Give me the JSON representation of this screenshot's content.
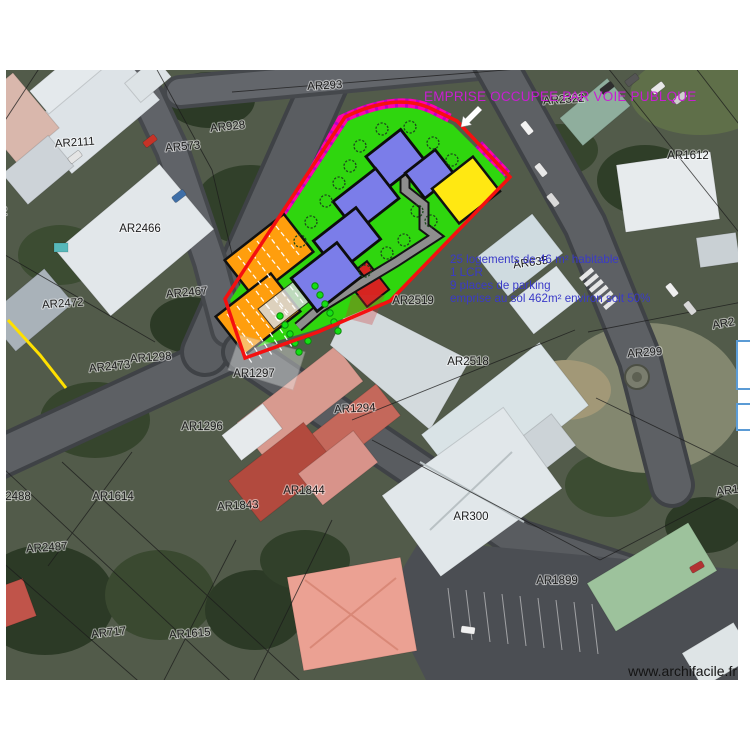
{
  "overlay": {
    "title": "EMPRISE OCCUPEE PAR VOIE PUBLQUE"
  },
  "annotations": {
    "line1": "25 logements de 46 m² habitable",
    "line2": "1 LCR",
    "line3": "9 places de parking",
    "line4": "emprise au sol 462m² environ soit 50%"
  },
  "watermark": "www.archifacile.fr",
  "parcels": [
    {
      "label": "AR293",
      "x": 325,
      "y": 89,
      "rot": -3
    },
    {
      "label": "AR2322",
      "x": 564,
      "y": 103,
      "rot": -4
    },
    {
      "label": "AR928",
      "x": 228,
      "y": 130,
      "rot": -6
    },
    {
      "label": "AR2111",
      "x": 75,
      "y": 146,
      "rot": -4
    },
    {
      "label": "AR573",
      "x": 183,
      "y": 150,
      "rot": -5
    },
    {
      "label": "AR1612",
      "x": 688,
      "y": 159,
      "rot": 0
    },
    {
      "label": "AR2466",
      "x": 140,
      "y": 232,
      "rot": 0
    },
    {
      "label": "AR2472",
      "x": 63,
      "y": 307,
      "rot": -4
    },
    {
      "label": "AR2467",
      "x": 187,
      "y": 296,
      "rot": -5
    },
    {
      "label": "AR635",
      "x": 531,
      "y": 266,
      "rot": -8
    },
    {
      "label": "AR2519",
      "x": 413,
      "y": 304,
      "rot": 0
    },
    {
      "label": "AR2473",
      "x": 110,
      "y": 370,
      "rot": -6
    },
    {
      "label": "AR1298",
      "x": 151,
      "y": 361,
      "rot": -4
    },
    {
      "label": "AR1297",
      "x": 254,
      "y": 377,
      "rot": 0
    },
    {
      "label": "AR2518",
      "x": 468,
      "y": 365,
      "rot": 0
    },
    {
      "label": "AR299",
      "x": 645,
      "y": 356,
      "rot": -4
    },
    {
      "label": "AR1294",
      "x": 355,
      "y": 412,
      "rot": -3
    },
    {
      "label": "AR1296",
      "x": 202,
      "y": 430,
      "rot": 0
    },
    {
      "label": "2488",
      "x": 18,
      "y": 500,
      "rot": 0
    },
    {
      "label": "AR1614",
      "x": 113,
      "y": 500,
      "rot": 0
    },
    {
      "label": "AR1844",
      "x": 304,
      "y": 494,
      "rot": 0
    },
    {
      "label": "AR1843",
      "x": 238,
      "y": 509,
      "rot": -3
    },
    {
      "label": "AR300",
      "x": 471,
      "y": 520,
      "rot": 0
    },
    {
      "label": "AR2487",
      "x": 47,
      "y": 551,
      "rot": -4
    },
    {
      "label": "AR1899",
      "x": 557,
      "y": 584,
      "rot": 0
    },
    {
      "label": "AR717",
      "x": 109,
      "y": 636,
      "rot": -6
    },
    {
      "label": "AR1615",
      "x": 190,
      "y": 637,
      "rot": -4
    },
    {
      "label": "AR2",
      "x": 724,
      "y": 327,
      "rot": -10
    },
    {
      "label": "AR1",
      "x": 728,
      "y": 494,
      "rot": -8
    },
    {
      "label": "2",
      "x": 4,
      "y": 215,
      "rot": 0
    }
  ],
  "colors": {
    "boundary_red": "#f51010",
    "public_way_magenta": "#ff00b0",
    "green_space": "#2fd60e",
    "building_blue": "#7b7de9",
    "zone_yellow": "#ffe812",
    "zone_orange": "#ff9e0d",
    "zone_red": "#d62420",
    "path_gray": "#8e8e8e",
    "annotation_blue": "#3a3ac8",
    "title_magenta": "#c81ed2"
  }
}
